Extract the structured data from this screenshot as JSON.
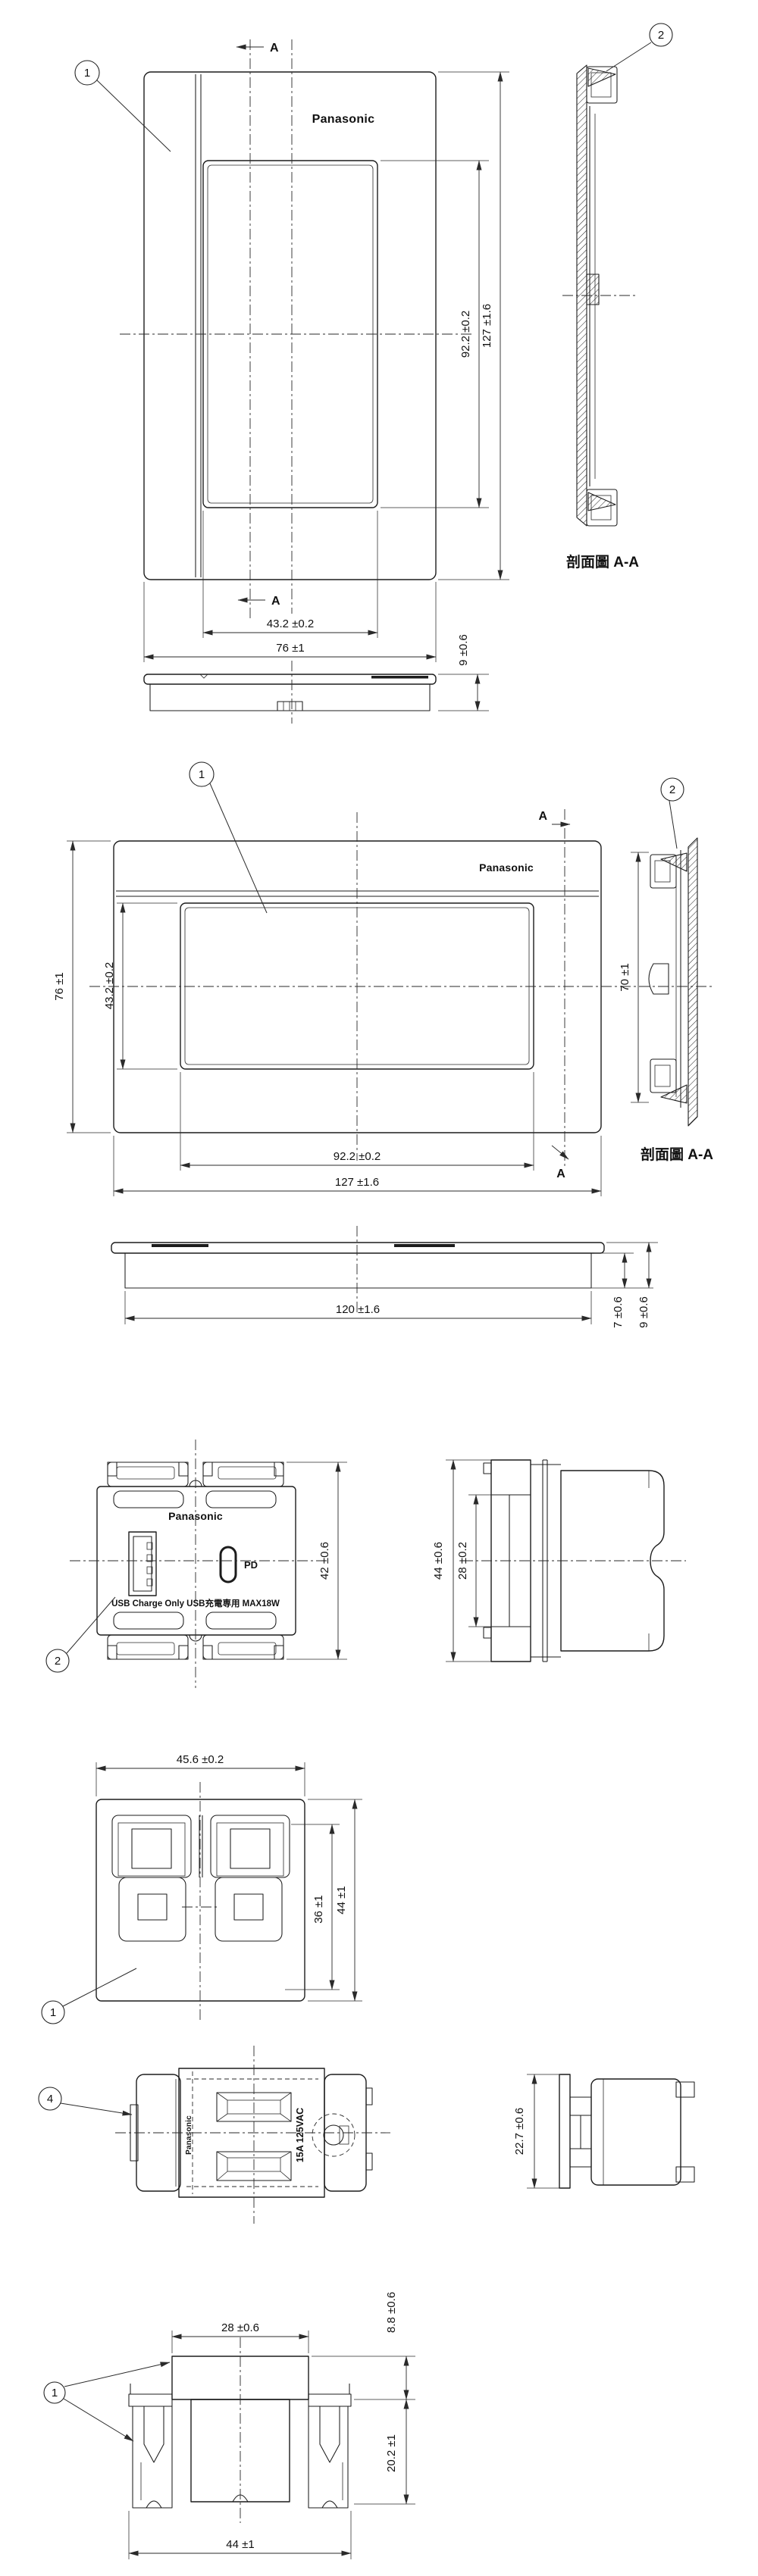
{
  "labels": {
    "brand": "Panasonic",
    "section_view": "剖面圖 A-A",
    "marker": "A",
    "balloon1": "1",
    "balloon2": "2",
    "balloon4": "4",
    "usb_caption": "USB Charge Only  USB充電専用  MAX18W",
    "pd": "PD",
    "rating": "15A 125VAC"
  },
  "dims": {
    "plate_portrait": {
      "inner_h": "92.2 ±0.2",
      "outer_h": "127 ±1.6",
      "inner_w": "43.2 ±0.2",
      "outer_w": "76 ±1",
      "thickness": "9 ±0.6"
    },
    "plate_landscape": {
      "outer_h": "76 ±1",
      "inner_h": "43.2 ±0.2",
      "inner_w": "92.2 ±0.2",
      "outer_w": "127 ±1.6",
      "section_h": "70 ±1",
      "body_w": "120 ±1.6",
      "t1": "7 ±0.6",
      "t2": "9 ±0.6"
    },
    "usb_module": {
      "height": "42 ±0.6",
      "side_outer": "44 ±0.6",
      "side_inner": "28 ±0.2"
    },
    "frame": {
      "width": "45.6 ±0.2",
      "inner_h": "36 ±1",
      "outer_h": "44 ±1"
    },
    "rear": {
      "side_h": "22.7 ±0.6"
    },
    "bottom_view": {
      "top_w": "28 ±0.6",
      "upper_h": "8.8 ±0.6",
      "lower_h": "20.2 ±1",
      "width": "44 ±1"
    }
  }
}
